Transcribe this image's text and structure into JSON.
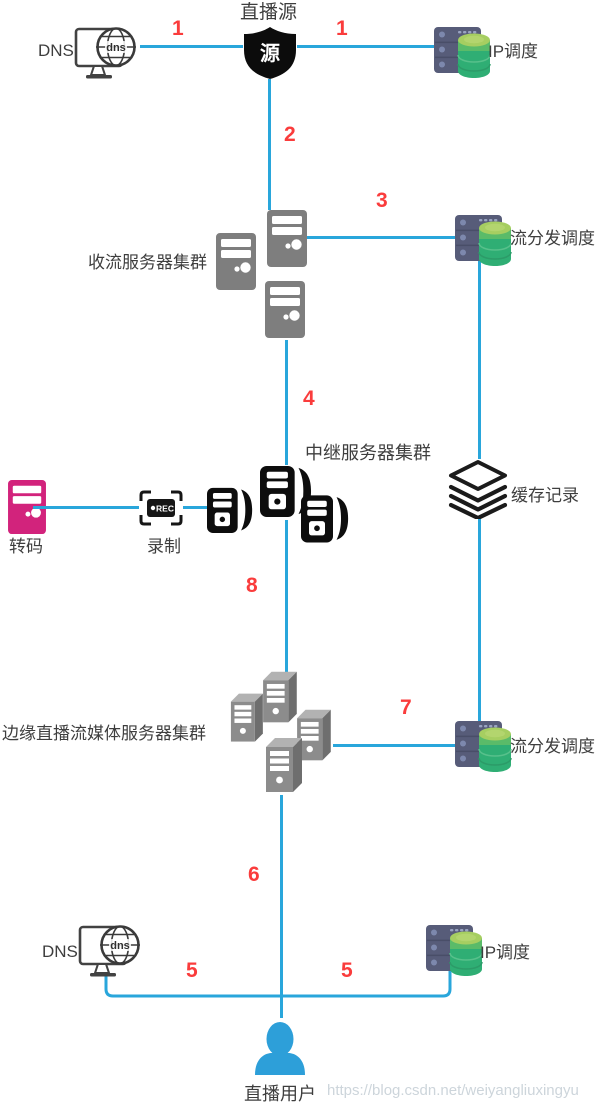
{
  "diagram": {
    "nodes": {
      "live_source": {
        "label": "直播源",
        "shield_glyph": "源"
      },
      "dns_top": {
        "label": "DNS",
        "globe_text": "dns"
      },
      "ip_sched_top": {
        "label": "IP调度"
      },
      "ingest_cluster": {
        "label": "收流服务器集群"
      },
      "dispatch_top": {
        "label": "流分发调度"
      },
      "relay_cluster": {
        "label": "中继服务器集群"
      },
      "cache": {
        "label": "缓存记录"
      },
      "transcode": {
        "label": "转码"
      },
      "record": {
        "label": "录制",
        "badge": "REC"
      },
      "edge_cluster": {
        "label": "边缘直播流媒体服务器集群"
      },
      "dispatch_bottom": {
        "label": "流分发调度"
      },
      "dns_bottom": {
        "label": "DNS"
      },
      "ip_sched_bottom": {
        "label": "IP调度"
      },
      "live_user": {
        "label": "直播用户"
      }
    },
    "step_labels": {
      "s1_left": "1",
      "s1_right": "1",
      "s2": "2",
      "s3": "3",
      "s4": "4",
      "s5_left": "5",
      "s5_right": "5",
      "s6": "6",
      "s7": "7",
      "s8": "8"
    },
    "watermark": "https://blog.csdn.net/weiyangliuxingyu",
    "colors": {
      "line": "#29A6DB",
      "step_number": "#FA3C3C",
      "server_gray": "#7E7E7E",
      "transcode_pink": "#D2237C",
      "rack_navy": "#575C79",
      "db_green_top": "#A6CE61",
      "db_green": "#2FAE74",
      "user_blue": "#2D9FD9",
      "icon_black": "#0D0D0D"
    }
  }
}
